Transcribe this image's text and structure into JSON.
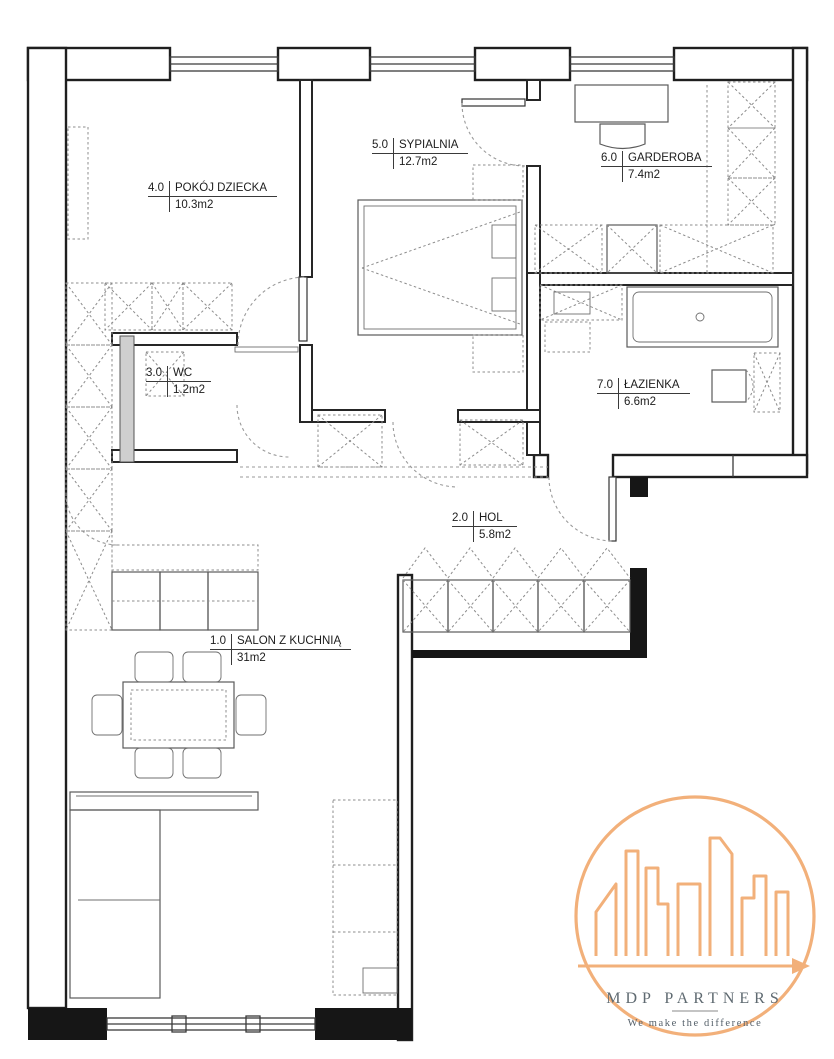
{
  "plan": {
    "rooms": [
      {
        "id": "pokoj-dziecka",
        "number": "4.0",
        "name": "POKÓJ DZIECKA",
        "area": "10.3m2"
      },
      {
        "id": "sypialnia",
        "number": "5.0",
        "name": "SYPIALNIA",
        "area": "12.7m2"
      },
      {
        "id": "garderoba",
        "number": "6.0",
        "name": "GARDEROBA",
        "area": "7.4m2"
      },
      {
        "id": "wc",
        "number": "3.0",
        "name": "WC",
        "area": "1.2m2"
      },
      {
        "id": "lazienka",
        "number": "7.0",
        "name": "ŁAZIENKA",
        "area": "6.6m2"
      },
      {
        "id": "hol",
        "number": "2.0",
        "name": "HOL",
        "area": "5.8m2"
      },
      {
        "id": "salon",
        "number": "1.0",
        "name": "SALON Z KUCHNIĄ",
        "area": "31m2"
      }
    ]
  },
  "logo": {
    "title": "MDP PARTNERS",
    "tagline": "We make the difference",
    "accent_color": "#f2b07a",
    "text_color": "#5f6a71"
  },
  "colors": {
    "background": "#ffffff",
    "wall_line": "#1f1f1f",
    "furniture_line": "#5a5a5a",
    "dashed_line": "#8c8c8c"
  }
}
